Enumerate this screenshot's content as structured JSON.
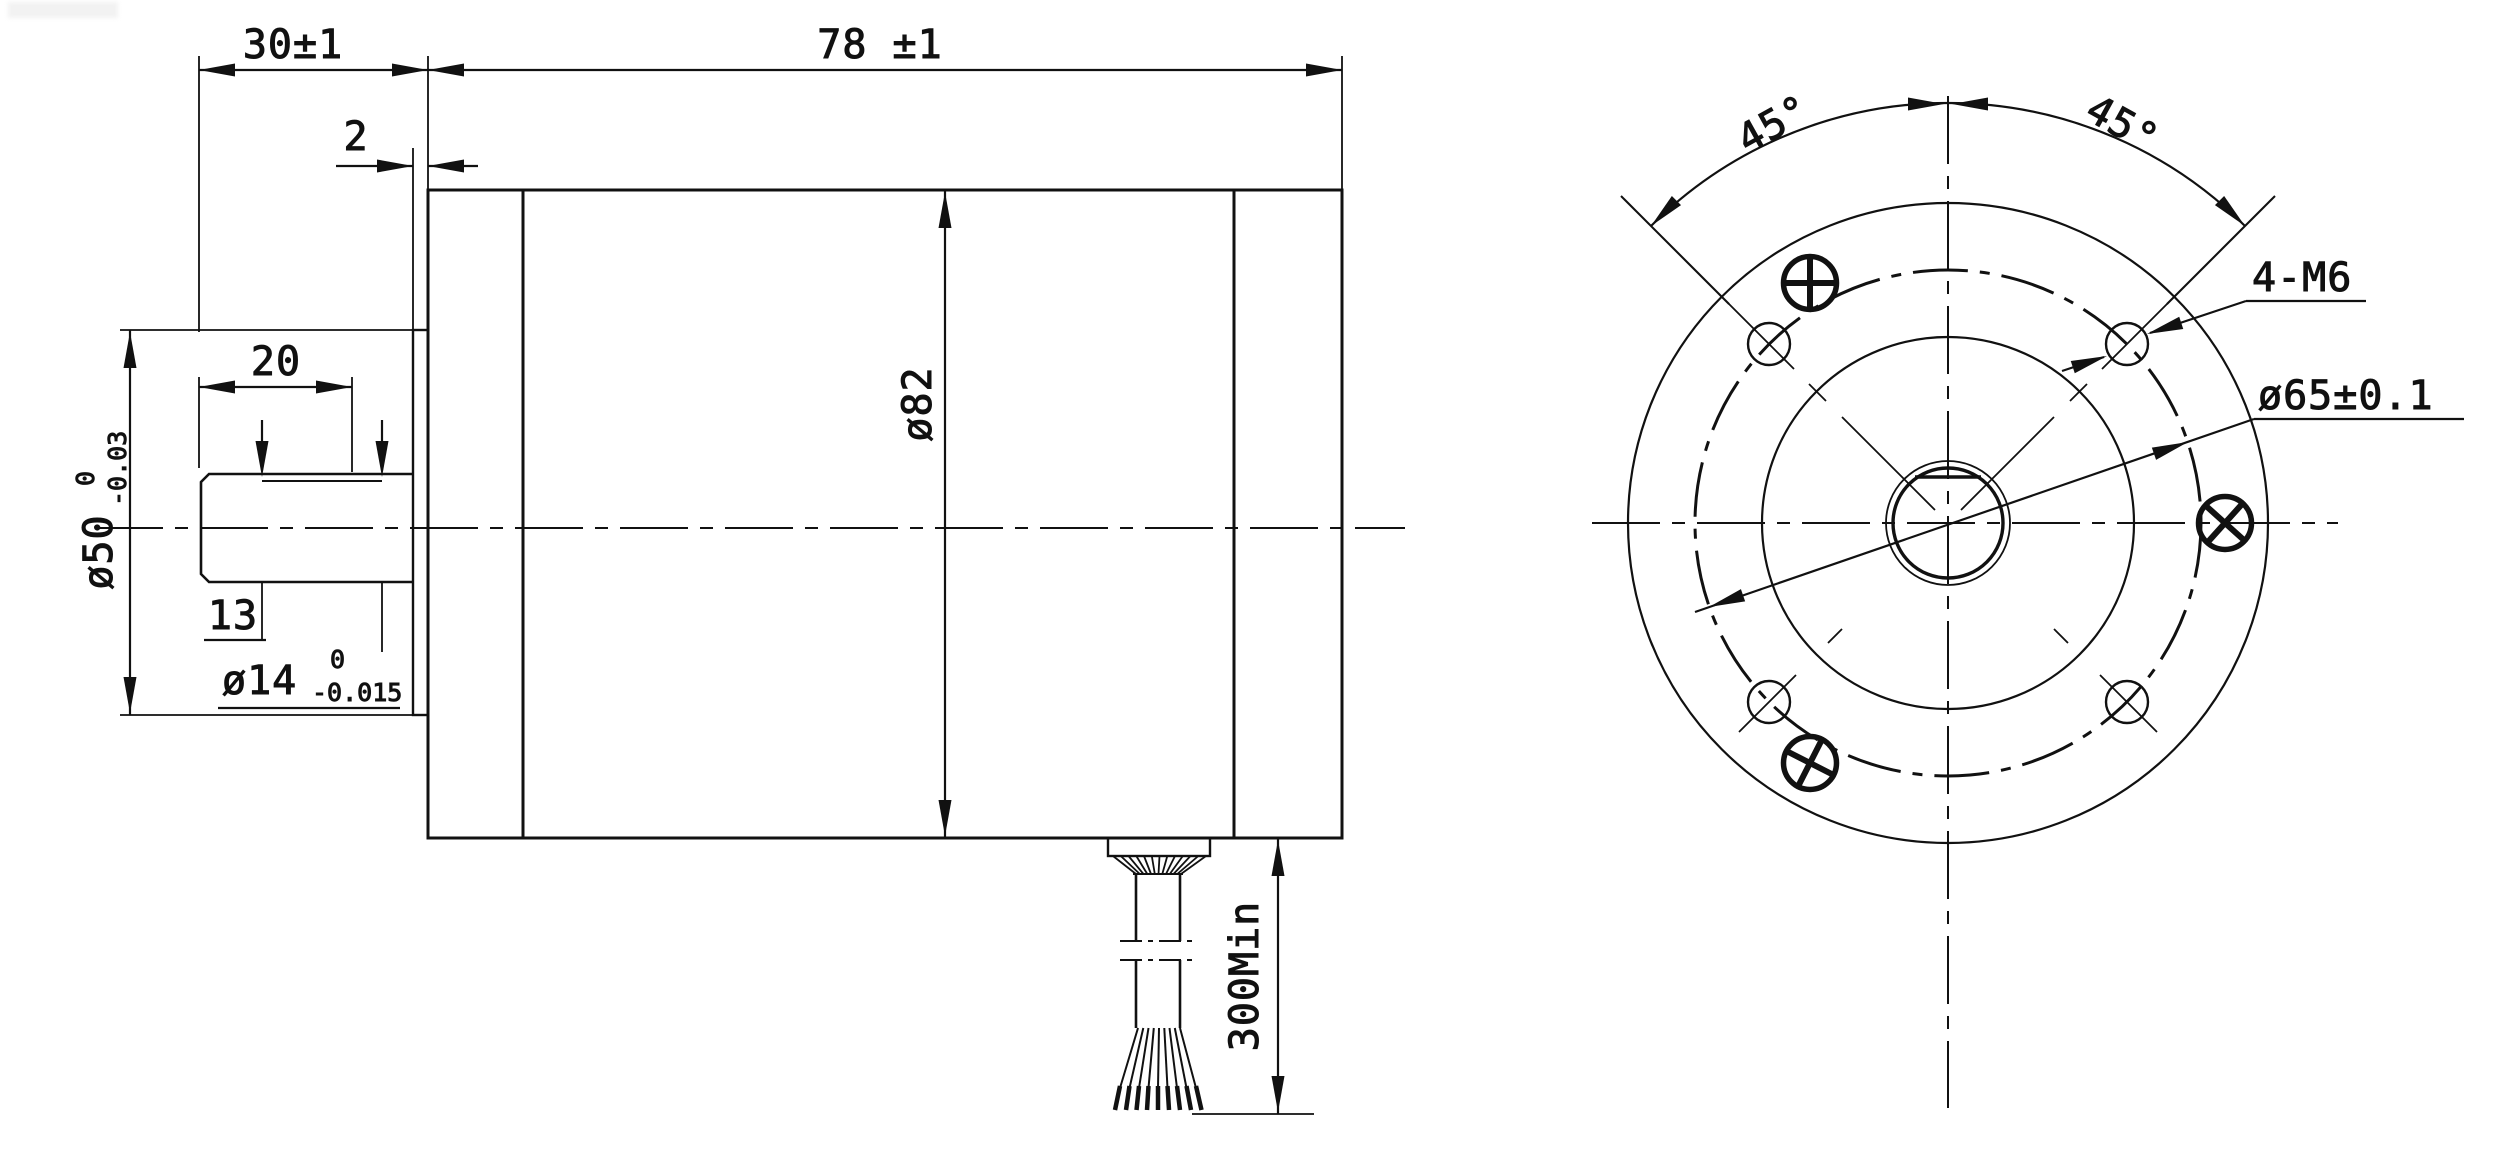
{
  "drawing": {
    "background": "#ffffff",
    "line_color": "#111111",
    "title": "motor-outline-drawing",
    "side_view": {
      "dim_front_length": "30±1",
      "dim_body_length": "78 ±1",
      "dim_boss_thickness": "2",
      "dim_shaft_length": "20",
      "dim_flat_length": "13",
      "dim_shaft_dia": "ø14",
      "dim_shaft_dia_tol_upper": "0",
      "dim_shaft_dia_tol_lower": "-0.015",
      "dim_pilot_dia": "ø50",
      "dim_pilot_dia_tol_upper": "0",
      "dim_pilot_dia_tol_lower": "-0.03",
      "dim_body_dia": "ø82",
      "dim_cable_length": "300Min"
    },
    "front_view": {
      "dim_angle_left": "45°",
      "dim_angle_right": "45°",
      "label_mounting_holes": "4-M6",
      "dim_bolt_circle": "ø65±0.1"
    }
  }
}
